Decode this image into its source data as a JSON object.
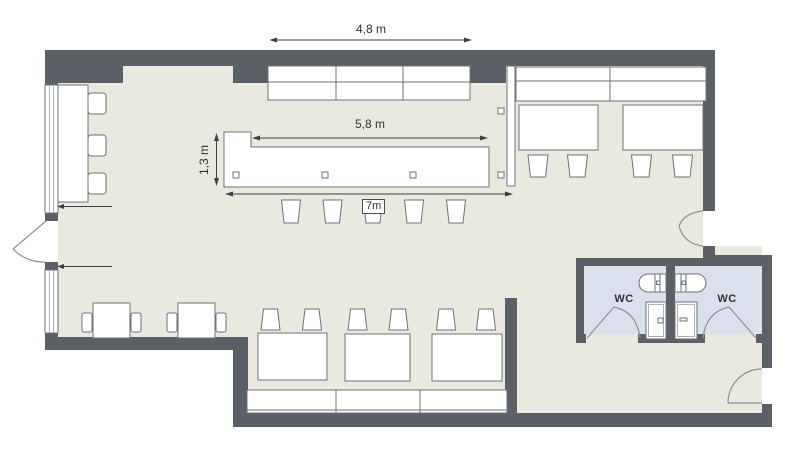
{
  "plan": {
    "dimensions": {
      "bench_row": "4,8 m",
      "bar_inner": "5,8 m",
      "bar_depth": "1,3 m",
      "bar_total": "7m"
    },
    "rooms": {
      "wc_left": "WC",
      "wc_right": "WC"
    },
    "colors": {
      "wall": "#5b6067",
      "floor": "#eae9e0",
      "wc_floor": "#dbe1ec",
      "furniture": "#ffffff",
      "outline": "#6d7278",
      "dimension": "#3d4145",
      "door": "#8b9095",
      "text": "#2e3236",
      "background": "#ffffff"
    }
  }
}
